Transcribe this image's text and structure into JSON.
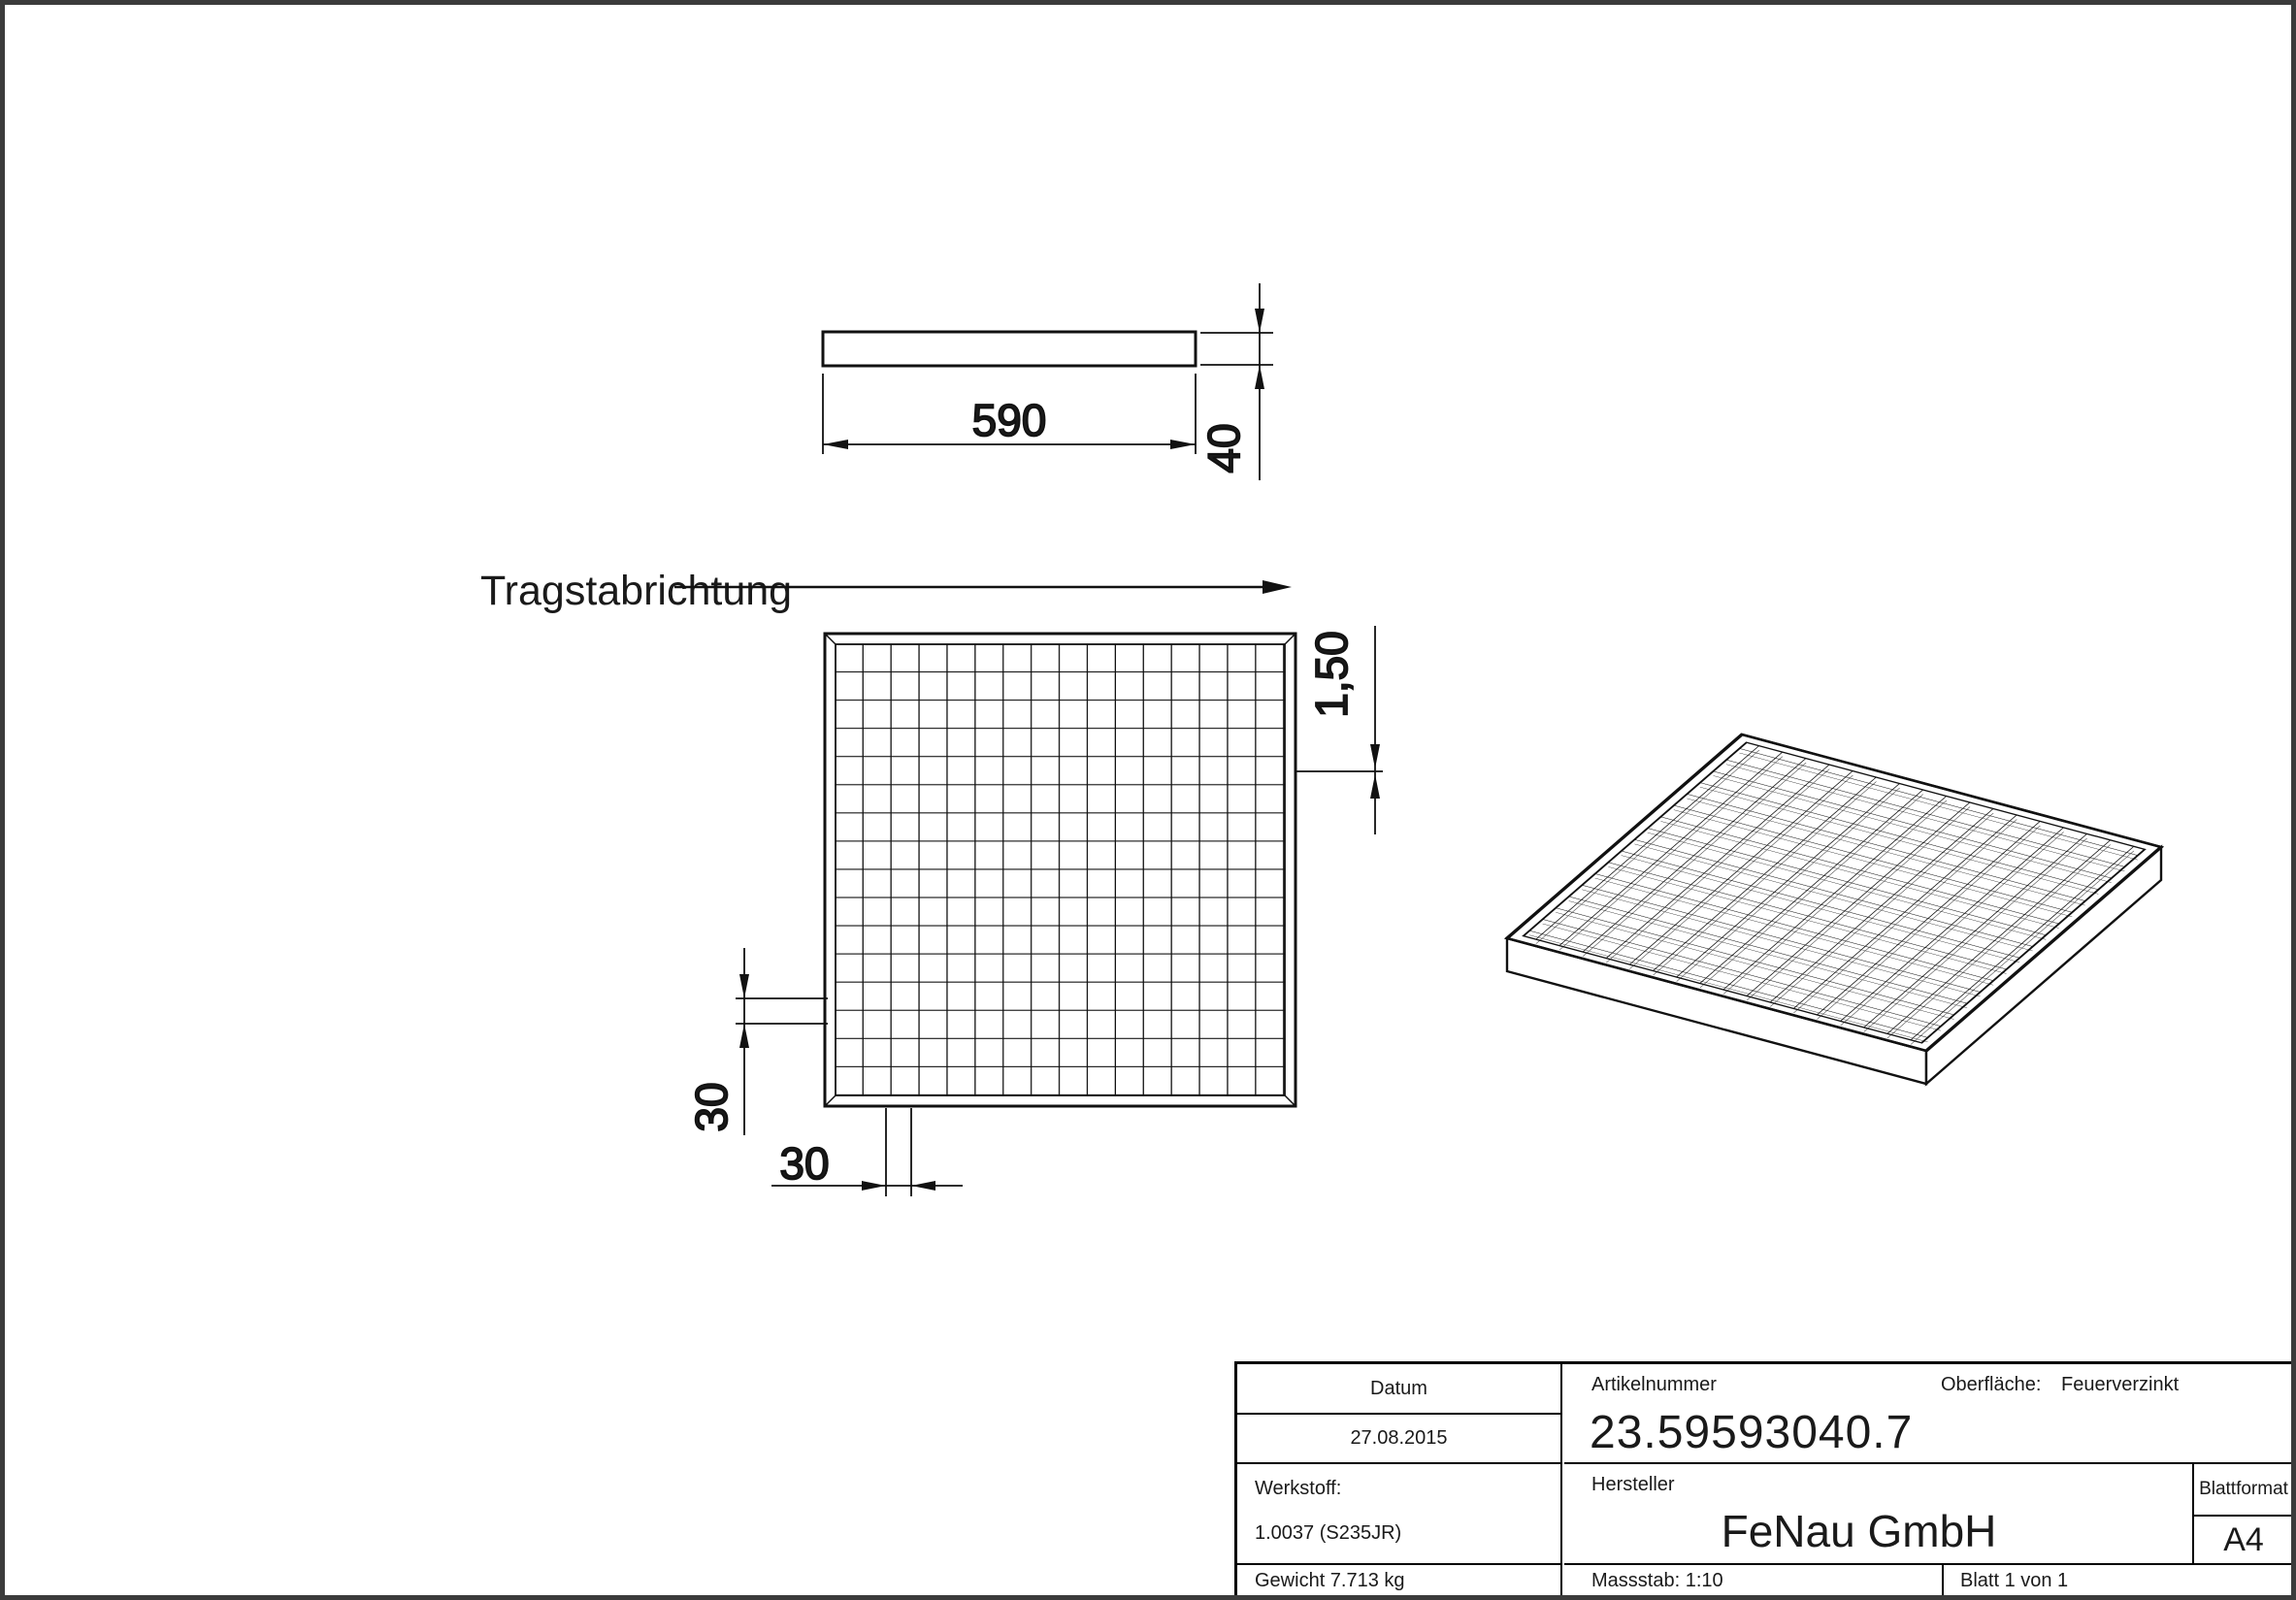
{
  "page": {
    "line_color": "#111111",
    "border_color": "#3b3b3b"
  },
  "drawing": {
    "direction_label": "Tragstabrichtung",
    "dim_length": "590",
    "dim_height": "40",
    "dim_bar_thickness": "1,50",
    "dim_pitch_vertical": "30",
    "dim_pitch_horizontal": "30"
  },
  "title_block": {
    "datum_label": "Datum",
    "datum_value": "27.08.2015",
    "artikelnummer_label": "Artikelnummer",
    "artikelnummer_value": "23.59593040.7",
    "oberflaeche_label": "Oberfläche:",
    "oberflaeche_value": "Feuerverzinkt",
    "werkstoff_label": "Werkstoff:",
    "werkstoff_value": "1.0037 (S235JR)",
    "hersteller_label": "Hersteller",
    "hersteller_value": "FeNau GmbH",
    "blattformat_label": "Blattformat",
    "blattformat_value": "A4",
    "gewicht": "Gewicht 7.713 kg",
    "massstab": "Massstab: 1:10",
    "blatt": "Blatt 1 von 1"
  }
}
